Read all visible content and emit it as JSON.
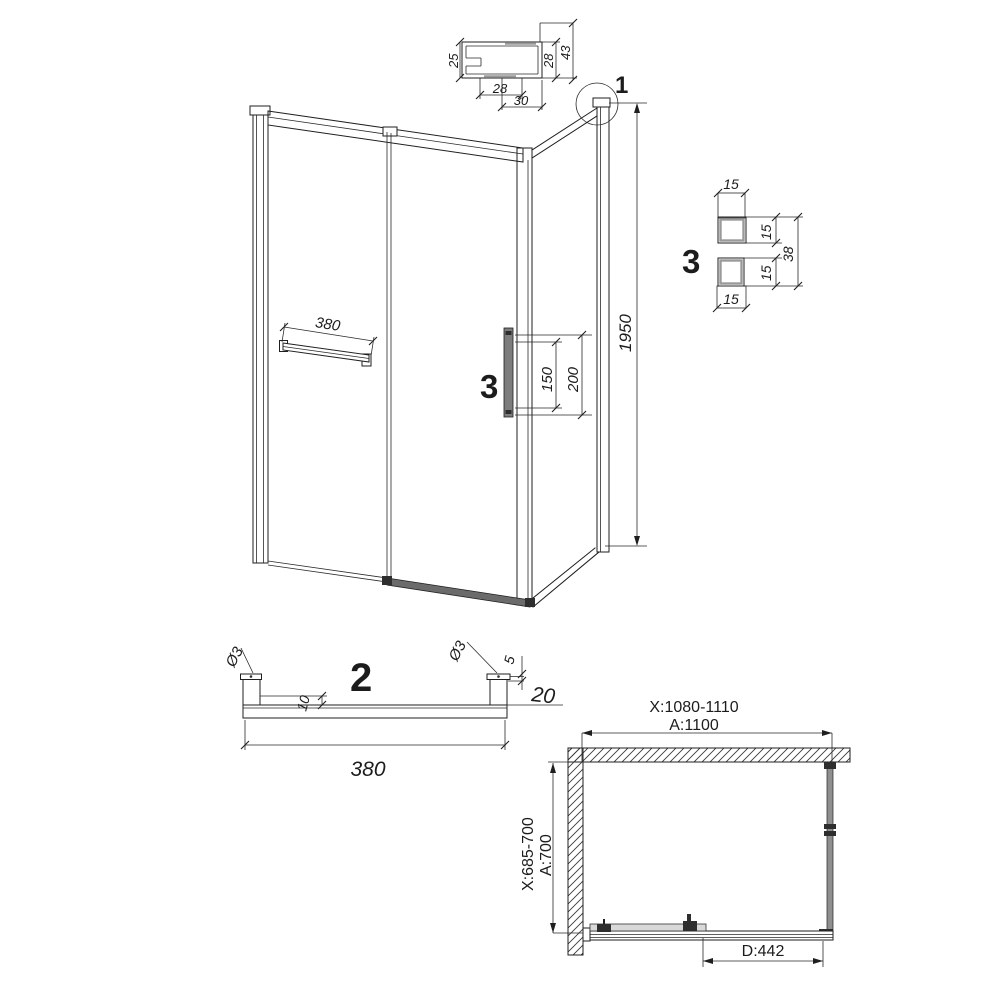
{
  "detail1_profile": {
    "dim_left": "25",
    "dim_bottom_inner": "28",
    "dim_bottom_outer": "30",
    "dim_right_inner": "28",
    "dim_right_outer": "43"
  },
  "main_view": {
    "callout_label": "1",
    "height_dim": "1950",
    "towel_bar_dim": "380",
    "handle_label": "3",
    "handle_grip_dim": "150",
    "handle_overall_dim": "200"
  },
  "detail3_handle": {
    "label": "3",
    "dim_top": "15",
    "dim_right_upper": "15",
    "dim_right_lower": "15",
    "dim_right_overall": "38",
    "dim_bottom": "15"
  },
  "detail2_bar": {
    "label": "2",
    "dim_left_pin_dia": "Ø3",
    "dim_right_pin_dia": "Ø3",
    "dim_pin_height": "5",
    "dim_inset": "10",
    "dim_bar_height": "20",
    "dim_length": "380"
  },
  "plan_view": {
    "adjust_width": "X:1080-1110",
    "nominal_width": "A:1100",
    "adjust_depth": "X:685-700",
    "nominal_depth": "A:700",
    "door_width": "D:442"
  }
}
